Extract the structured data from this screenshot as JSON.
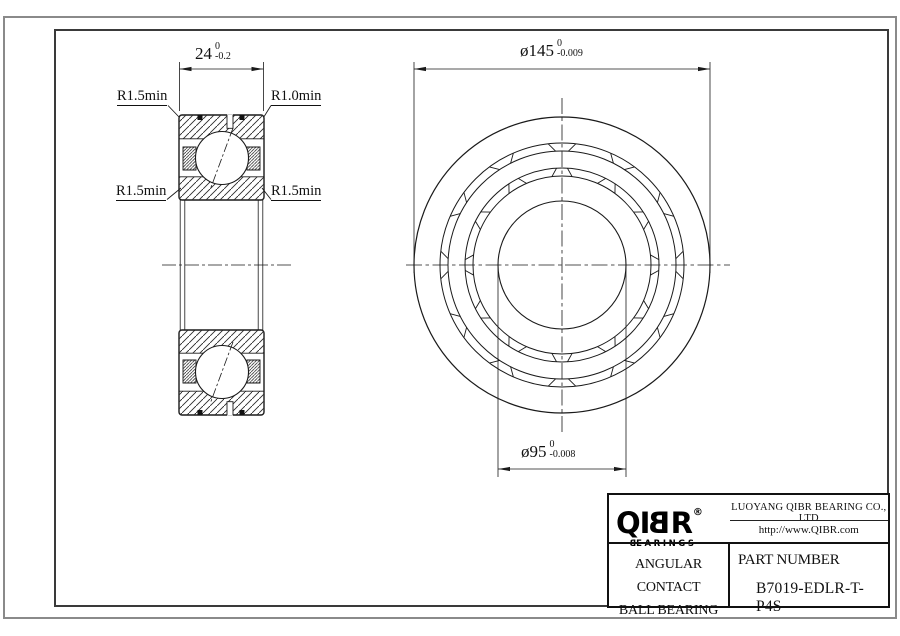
{
  "sheet": {
    "section_view": {
      "width_dim": {
        "value": "24",
        "tol_upper": "0",
        "tol_lower": "-0.2"
      },
      "label_top_left": "R1.5min",
      "label_top_right": "R1.0min",
      "label_mid_left": "R1.5min",
      "label_mid_right": "R1.5min"
    },
    "front_view": {
      "outer_dia": {
        "value": "ø145",
        "tol_upper": "0",
        "tol_lower": "-0.009"
      },
      "bore_dia": {
        "value": "ø95",
        "tol_upper": "0",
        "tol_lower": "-0.008"
      }
    },
    "title_block": {
      "logo_part1": "QI",
      "logo_part2": "B",
      "logo_part3": "R",
      "logo_reg": "®",
      "logo_sub_part1": "B",
      "logo_sub_part2": "EARINGS",
      "company": "LUOYANG QIBR BEARING CO., LTD",
      "website": "http://www.QIBR.com",
      "product_line1": "ANGULAR CONTACT",
      "product_line2": "BALL BEARING",
      "part_label": "PART NUMBER",
      "part_number": "B7019-EDLR-T-P4S"
    },
    "colors": {
      "line": "#1a1a1a",
      "frame": "#3a3a3a",
      "outer_border": "#8a8a8a",
      "background": "#ffffff"
    }
  }
}
